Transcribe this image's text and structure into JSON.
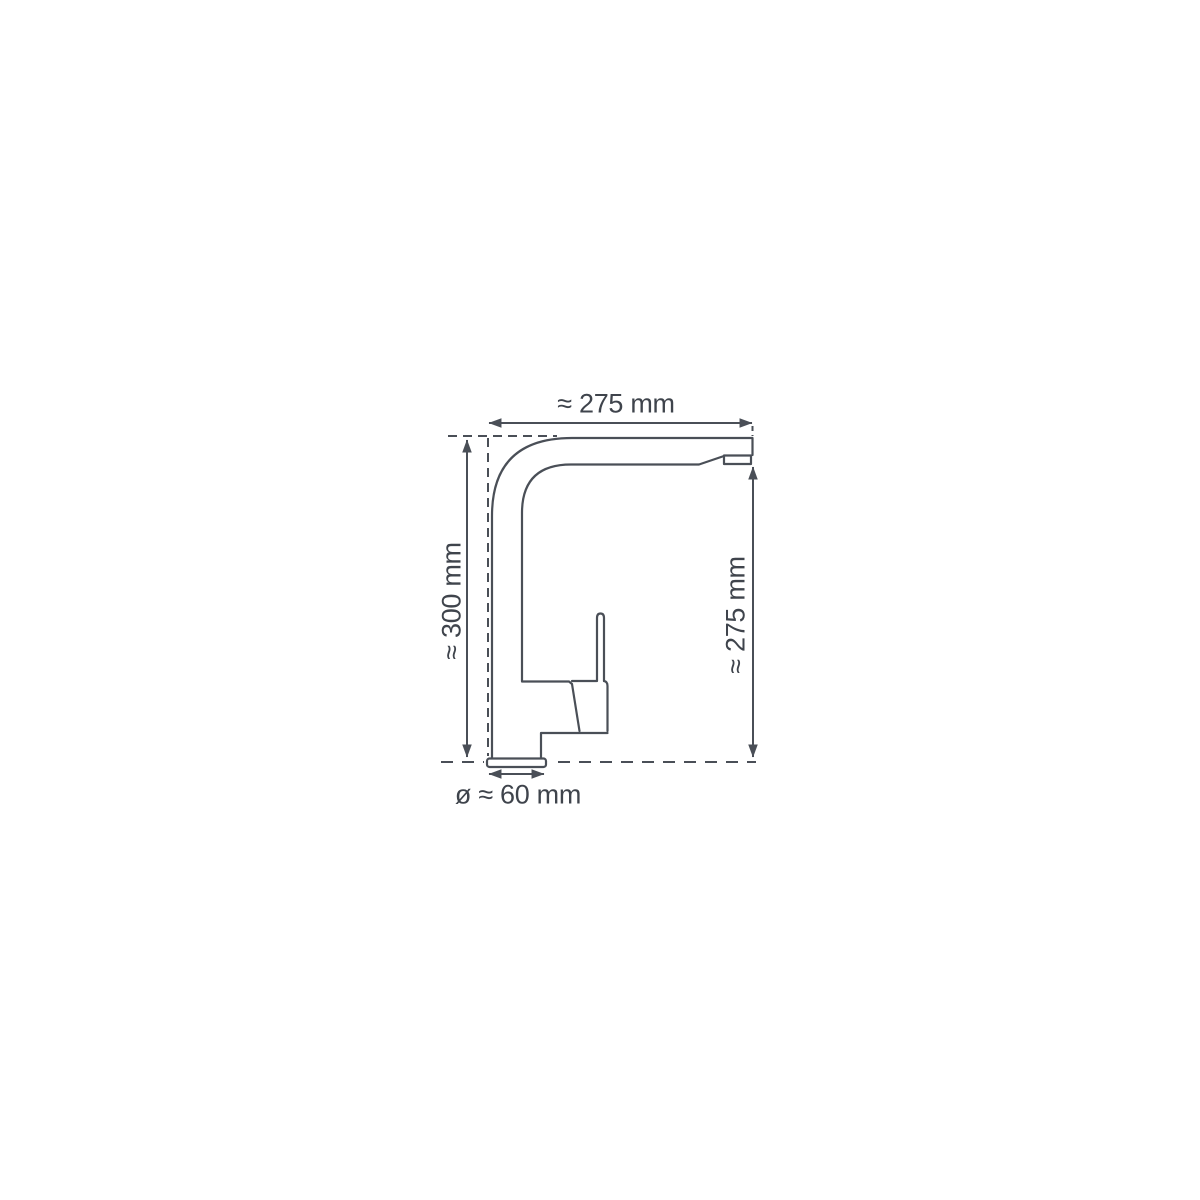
{
  "diagram": {
    "subject": "kitchen-mixer-tap-side-view-technical-drawing",
    "labels": {
      "top_width": "≈ 275 mm",
      "left_height": "≈ 300 mm",
      "right_height": "≈ 275 mm",
      "base_diameter": "ø ≈ 60 mm"
    },
    "colors": {
      "line": "#4a4f57",
      "text": "#3f444c",
      "background": "#ffffff"
    }
  }
}
